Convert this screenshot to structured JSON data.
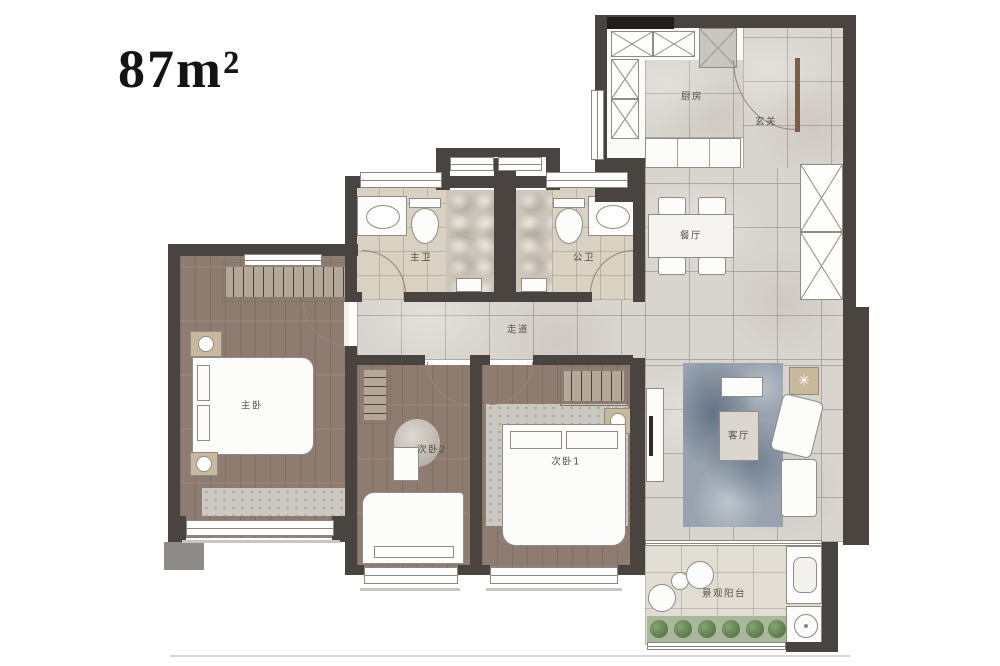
{
  "title": {
    "area_label": "87m²"
  },
  "rooms": {
    "kitchen": "厨房",
    "entry": "玄关",
    "dining": "餐厅",
    "master_bath": "主卫",
    "guest_bath": "公卫",
    "corridor": "走道",
    "master_bedroom": "主卧",
    "bedroom2": "次卧2",
    "bedroom1": "次卧1",
    "living_room": "客厅",
    "balcony": "景观阳台"
  },
  "colors": {
    "wall": "#4a4440",
    "wall-dark": "#211d1a",
    "tile": "#d8d4ce",
    "wood": "#8d7c6f",
    "bath": "#d9d1c1",
    "balcony": "#e2ddd2",
    "wardrobe": "#b4a999",
    "nightstand": "#c8b89c",
    "rug": "#98a3af",
    "plant": "#5c7a4b",
    "greenstrip": "#a9b79a"
  }
}
